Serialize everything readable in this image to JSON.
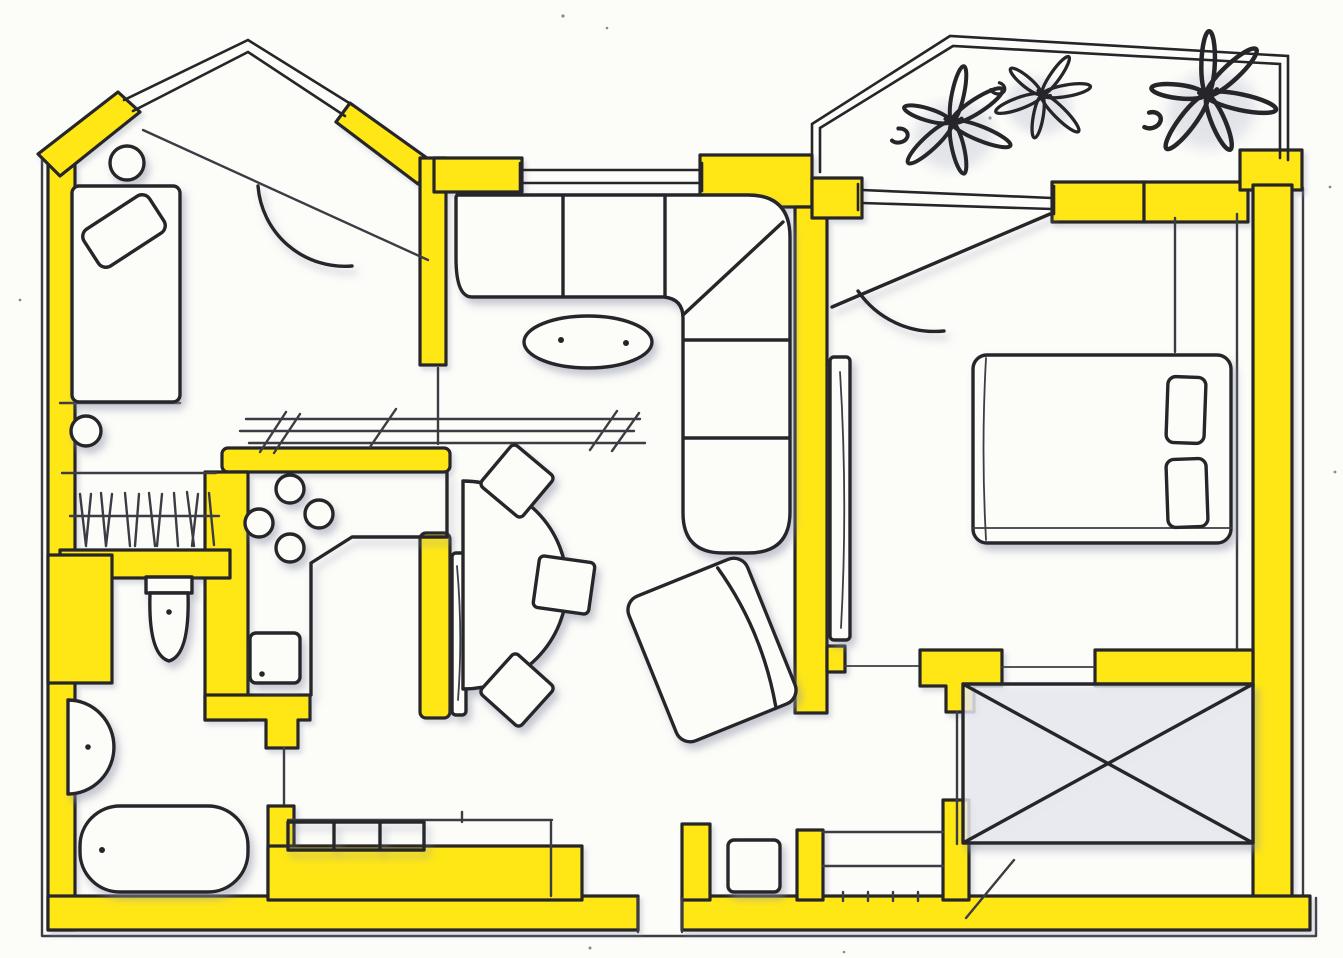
{
  "image": {
    "kind": "hand-drawn apartment floor plan, marker-highlighted walls on scanned paper",
    "width_px": 1343,
    "height_px": 958,
    "visible_text": "none"
  },
  "colors": {
    "wall_highlight": "#ffe716",
    "ink": "#26262a",
    "pencil": "#3c3c44",
    "paper": "#fcfcf9",
    "shade": "#c9cdd9",
    "smudge": "#8f93a8"
  },
  "elements": {
    "rooms": [
      "gabled-room-top-left",
      "living-room",
      "kitchen",
      "dining-nook",
      "wardrobe-closet",
      "bathroom",
      "hall",
      "bedroom-right",
      "balcony",
      "storage-x-room"
    ],
    "counts": {
      "balcony_plants": 3,
      "stove_burners": 4,
      "sofa_cushions": 6,
      "dining_chairs": 3,
      "beds": 2,
      "pillows": 3,
      "bath_fixtures": 3,
      "hanger_strokes": 12,
      "cabinet_squares": 3,
      "window_double_lines": 4,
      "door_swing_arcs": 2,
      "x_marked_boxes": 1
    }
  }
}
